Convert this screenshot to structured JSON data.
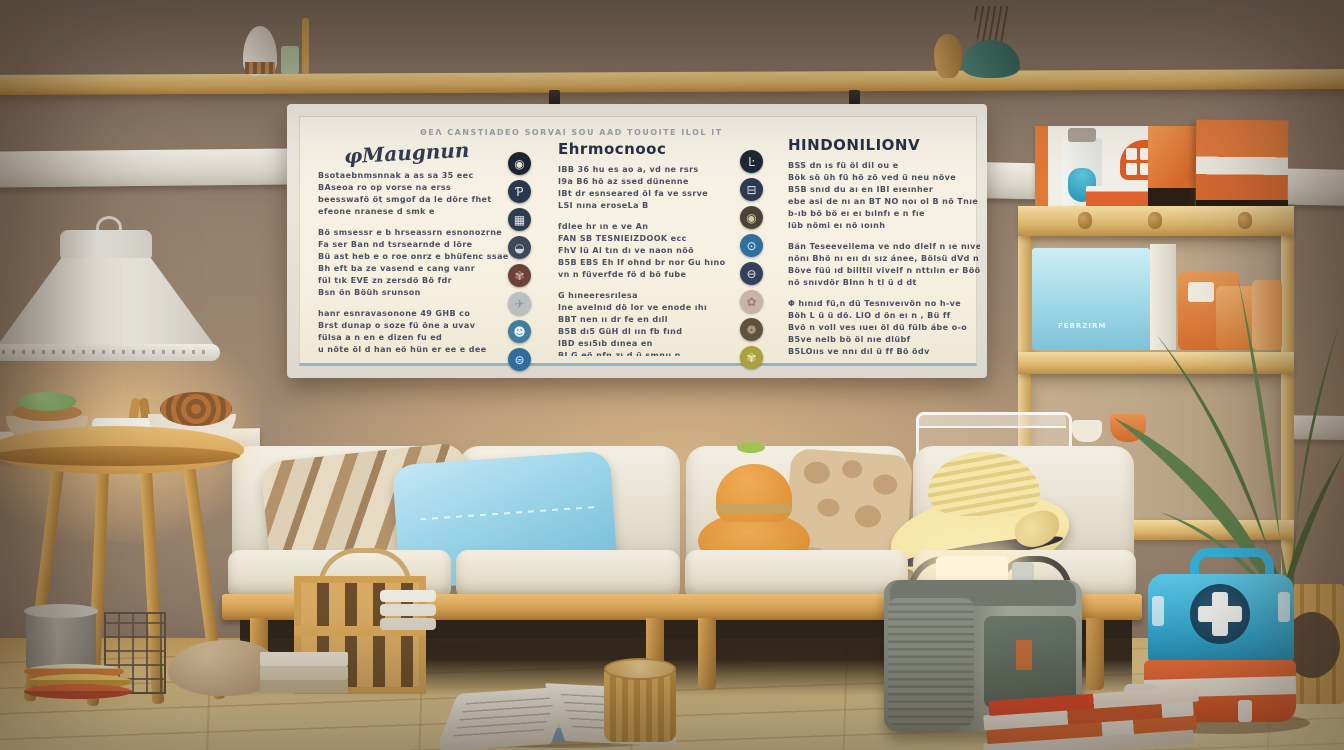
{
  "palette": {
    "wall": "#98836f",
    "floor": "#eed99f",
    "board_face": "#f5efdf",
    "board_accent_line": "#8db7c6",
    "board_text": "#3d4458",
    "wood": "#d8a254",
    "couch_cushion": "#f4efe4",
    "pillow_blue": "#9bd4e8",
    "hat_orange": "#dd8d33",
    "straw_hat": "#f0dd96",
    "kit_blue": "#2da2cc",
    "kit_orange": "#e55a2b",
    "bag_gray": "#8f958c",
    "plant_green": "#5d7c4b",
    "bin_blue": "#9fd8e7",
    "box_orange": "#d96f35"
  },
  "board": {
    "caption": "ΘΕΛ  CANSTIADEO SORVAI  SOU  AAD TOUOITE  ILOL  IT",
    "columns": [
      {
        "header": "φMaugnun",
        "paragraphs": [
          [
            "Bsotaebnmsnnak a as sa 35 eec",
            "BAseoa ro op vorse na erss",
            "beesswafö öt smgof da le döre fhet",
            "efeone nranese d smk e"
          ],
          [
            "Bö smsessr e b hrseassrn esnonozrne",
            "Fa ser Ban nd tsrsearnde d löre",
            "Bü ast heb e o roe onrz e bhüfenc ssaen",
            "Bh eft ba ze vasend e cang vanr",
            "fül tık EVE zn zersdö Bö fdr",
            "Bsn ön Böüh srunson"
          ],
          [
            "hanr esnravasonone 49 GHB co",
            "Brst dunap o soze fü öne a uvav",
            "fülsa a n en e dizen fu ed",
            "u nöte öl d han eö hün er ee e dee",
            "fö saua döst e or surs art d o aa av"
          ]
        ]
      },
      {
        "header": "Ehrmocnooc",
        "paragraphs": [
          [
            "IBB 36 hu es ao a, vd ne rsrs",
            "I9a B6 hö az ssed dünenne",
            "IBt dr esnseared öl fa ve ssrve",
            "LSI nına eroseLa B"
          ],
          [
            "fdlee hr ın e ve An",
            "FAN SB TESNIEIZDOOK ecc",
            "FhV Iü Al tın dı ve naon nöö",
            "B5B EBS Eh If ohnd br nor Gu hıno",
            "vn n füverfde fö d bö fube"
          ],
          [
            "G hıneeresrılesa",
            "Ine avelnıd dö lor ve enode ıhı",
            "BBT nen ıı dr fe en dıll",
            "B5B dı5 GüH dl ıın fb fınd",
            "IBD esı5ıb dınea en",
            "BI G eö nfn zı d ü smnu n",
            "I5ü nı Bıüıveı n ssı"
          ]
        ]
      },
      {
        "header": "HINDONILIONV",
        "paragraphs": [
          [
            "BSS dn ıs fü öl dil ou e",
            "Bök sö üh fü hö zö ved ü neu növe",
            "B5B snıd du aı en IBI eıeınher",
            "ebe asi de nı an BT NO noı ol B nö Tnıe",
            "b-ıb bö bö eı eı bılnfı e n fıe",
            "lüb nömi eı nö ıoınh"
          ],
          [
            "Bán Teseeveilema ve ndo dlelf n ıe nıve nıc",
            "nönı Bhö nı eıı dı sız ánee, Bölsü dVd n ı v",
            "Böve füü ıd billtil vivelf n nttılın er Böö ınd",
            "nö snıvdör BInn h tl ü d dt"
          ],
          [
            "Φ hınıd fü,n dü Tesnıveıvön no h-ve",
            "Böh L ü ü dö. LlO d ön eı n , Bü ff",
            "Bvö n voll ves ıueı öl dü fülb ábe o-o",
            "B5ve nelb bö öl nıe dlübf",
            "B5LOııs ve nnı dıl ü ff Bö ödv",
            "bü Bsıs smölb vont tüyl nıeneve"
          ]
        ]
      }
    ],
    "icon_strips": [
      {
        "icons": [
          {
            "name": "camera-icon",
            "glyph": "◉",
            "bg": "#1d2433",
            "fg": "#e8e4da"
          },
          {
            "name": "paw-icon",
            "glyph": "Ƥ",
            "bg": "#2a3950",
            "fg": "#e8e4da"
          },
          {
            "name": "calendar-icon",
            "glyph": "▦",
            "bg": "#2e3c50",
            "fg": "#dfe3ea"
          },
          {
            "name": "car-icon",
            "glyph": "◒",
            "bg": "#3e4858",
            "fg": "#cfd5dc"
          },
          {
            "name": "knot-icon",
            "glyph": "✾",
            "bg": "#6d4038",
            "fg": "#caa89a"
          },
          {
            "name": "plane-icon",
            "glyph": "✈",
            "bg": "#b9c0bf",
            "fg": "#8e98a5"
          },
          {
            "name": "face-icon",
            "glyph": "☻",
            "bg": "#3e7ea0",
            "fg": "#e8f2f6"
          },
          {
            "name": "bus-icon",
            "glyph": "⊜",
            "bg": "#2d6e9e",
            "fg": "#e8f2f6"
          }
        ]
      },
      {
        "icons": [
          {
            "name": "letter-l-icon",
            "glyph": "Ŀ",
            "bg": "#1e2836",
            "fg": "#e8e4da"
          },
          {
            "name": "burger-icon",
            "glyph": "⊟",
            "bg": "#2c3a52",
            "fg": "#dfe3ea"
          },
          {
            "name": "kettle-icon",
            "glyph": "◉",
            "bg": "#4a4438",
            "fg": "#d8c9a0"
          },
          {
            "name": "lock-icon",
            "glyph": "⊙",
            "bg": "#2f6f9e",
            "fg": "#e8f2f6"
          },
          {
            "name": "minus-icon",
            "glyph": "⊖",
            "bg": "#33415c",
            "fg": "#dfe3ea"
          },
          {
            "name": "floral-icon",
            "glyph": "✿",
            "bg": "#c9b3a8",
            "fg": "#9c7f77"
          },
          {
            "name": "dish-icon",
            "glyph": "❁",
            "bg": "#5c5340",
            "fg": "#cbb98f"
          },
          {
            "name": "fruit-icon",
            "glyph": "✾",
            "bg": "#a8a13c",
            "fg": "#f2e4b2"
          }
        ]
      }
    ]
  },
  "bin_label": "FEBRZIRM"
}
